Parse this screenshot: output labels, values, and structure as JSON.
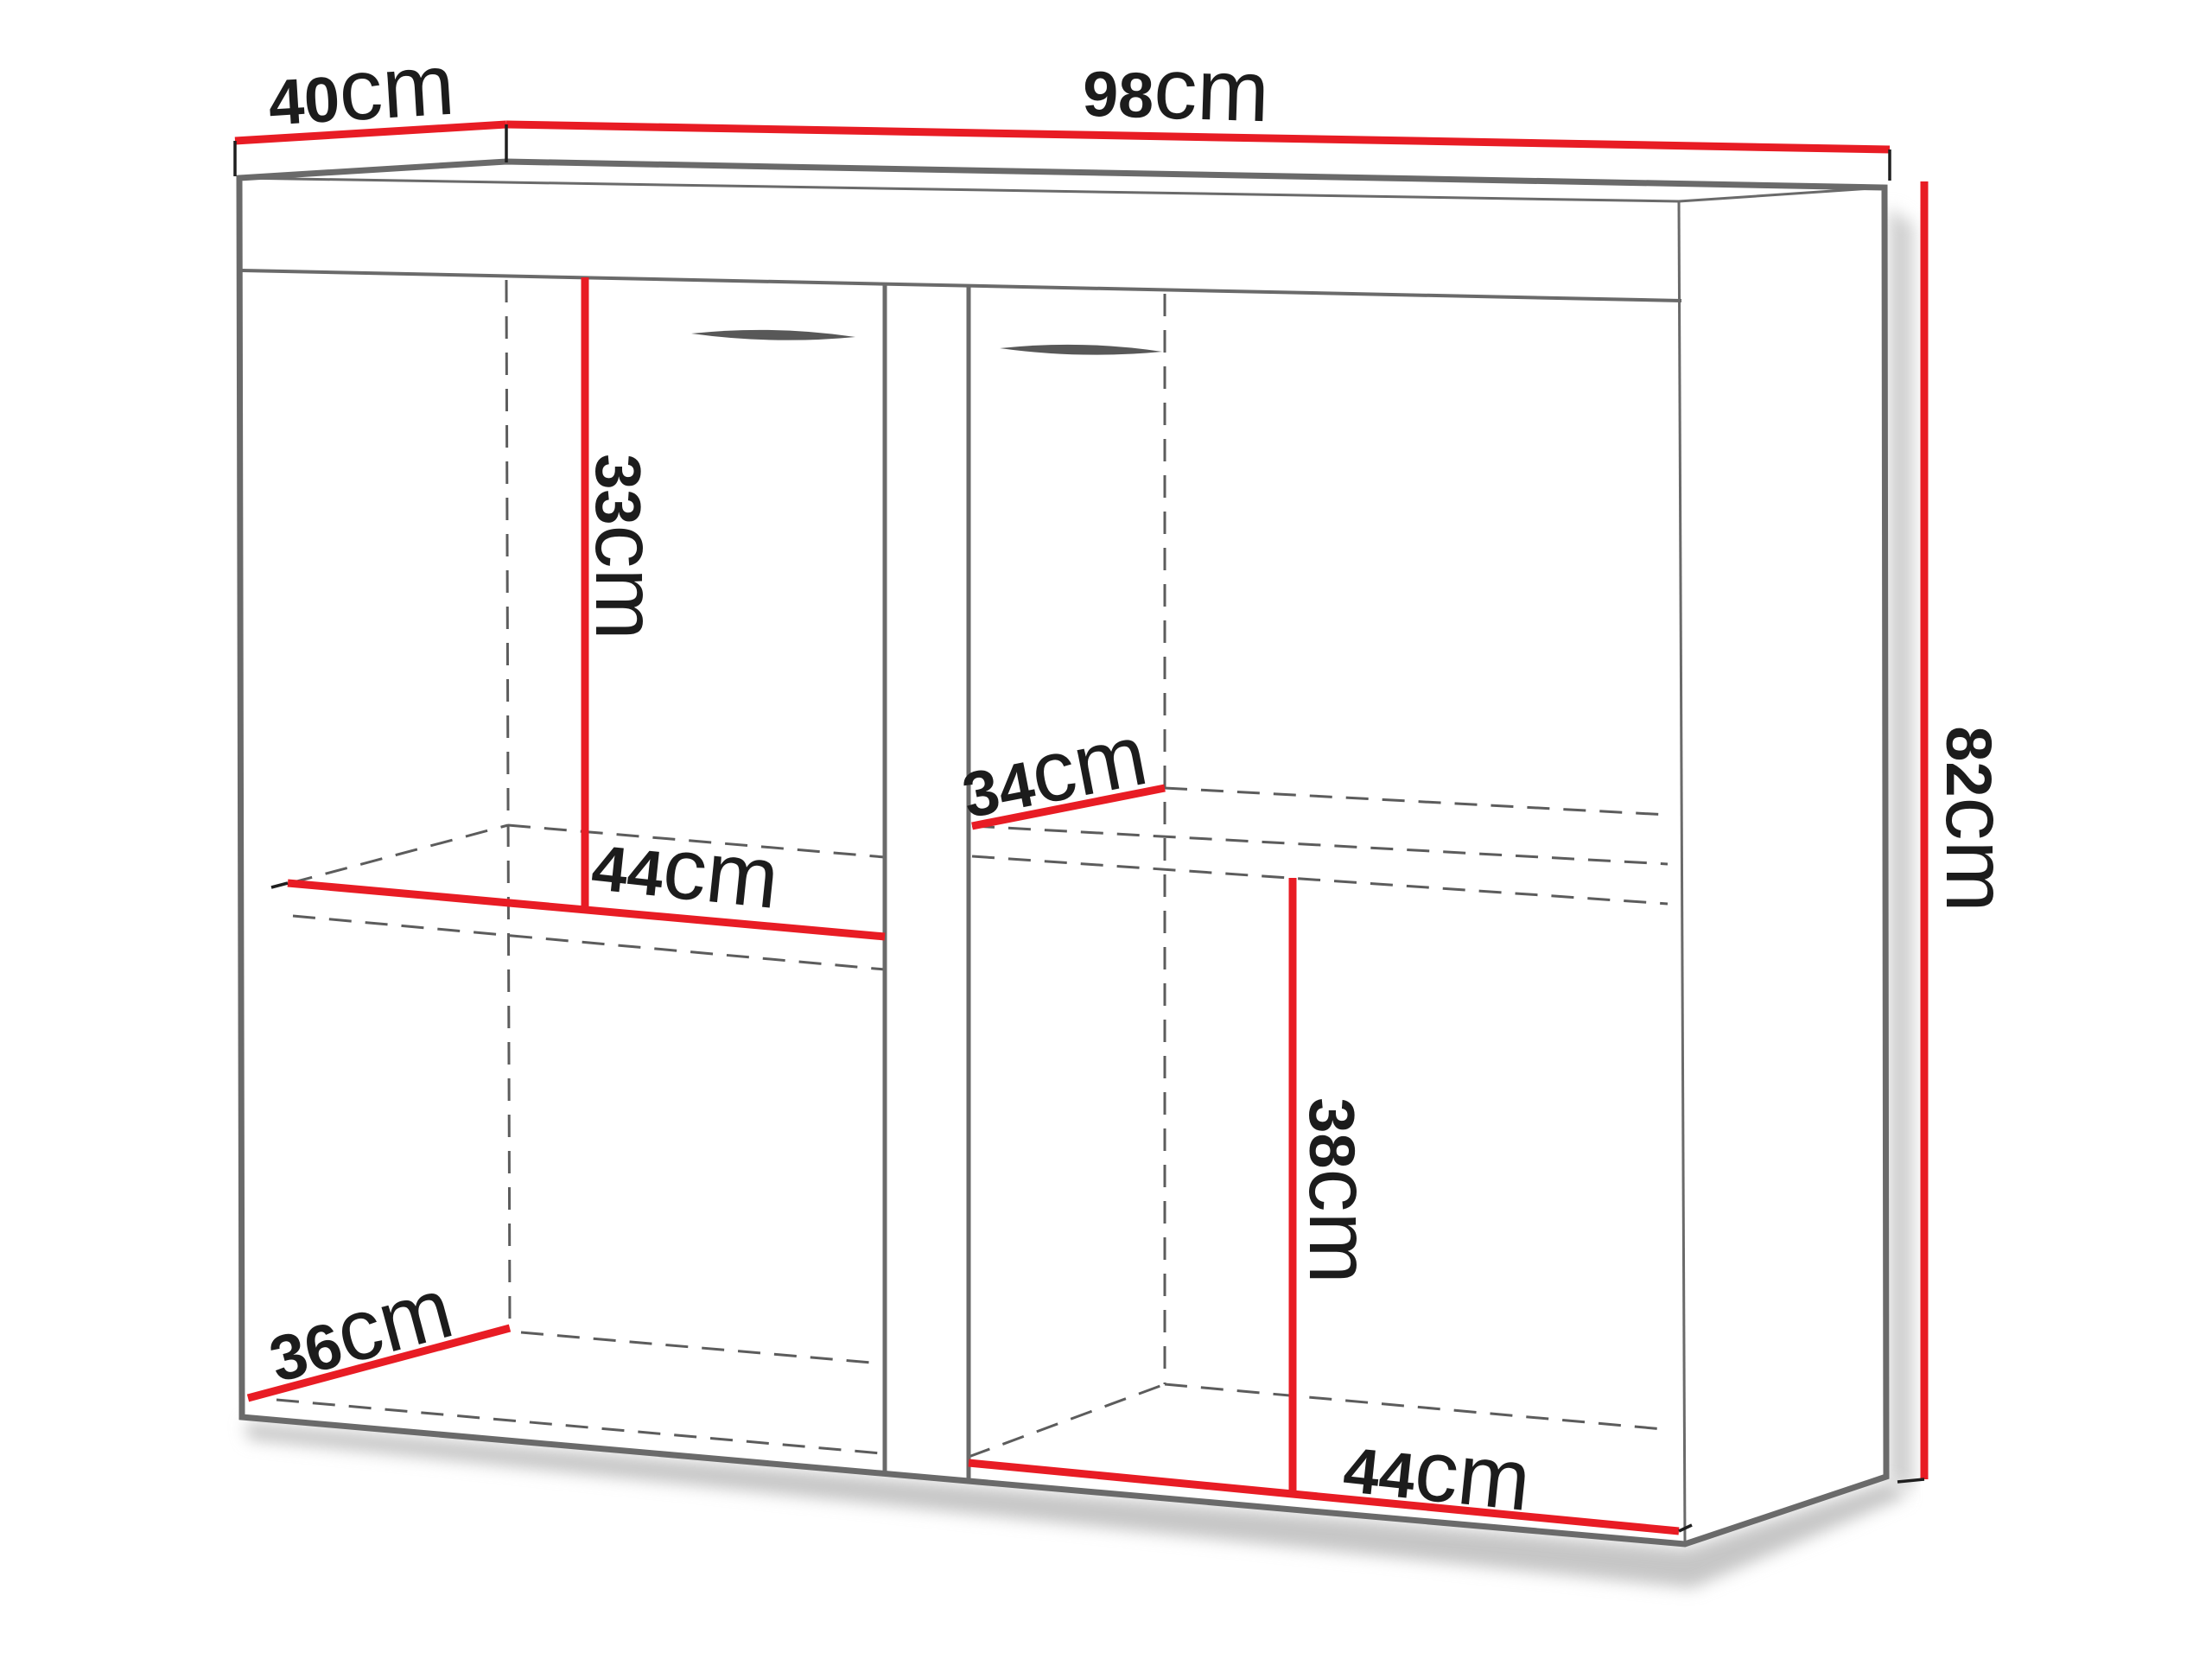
{
  "diagram": {
    "type": "furniture-dimension-diagram",
    "object": "sideboard",
    "dimensions": {
      "top_depth": {
        "value": "40",
        "unit": "cm"
      },
      "top_width": {
        "value": "98",
        "unit": "cm"
      },
      "height": {
        "value": "82",
        "unit": "cm"
      },
      "upper_shelf_clearance": {
        "value": "33",
        "unit": "cm"
      },
      "left_shelf_width": {
        "value": "44",
        "unit": "cm"
      },
      "right_shelf_depth": {
        "value": "34",
        "unit": "cm"
      },
      "lower_shelf_clearance": {
        "value": "38",
        "unit": "cm"
      },
      "interior_depth": {
        "value": "36",
        "unit": "cm"
      },
      "right_interior_width": {
        "value": "44",
        "unit": "cm"
      }
    },
    "colors": {
      "dimension_line": "#e81c24",
      "outline": "#6a6a6a",
      "hidden_edge": "#5c5c5c",
      "tick": "#1f1f1f",
      "text": "#1c1c1c"
    }
  }
}
